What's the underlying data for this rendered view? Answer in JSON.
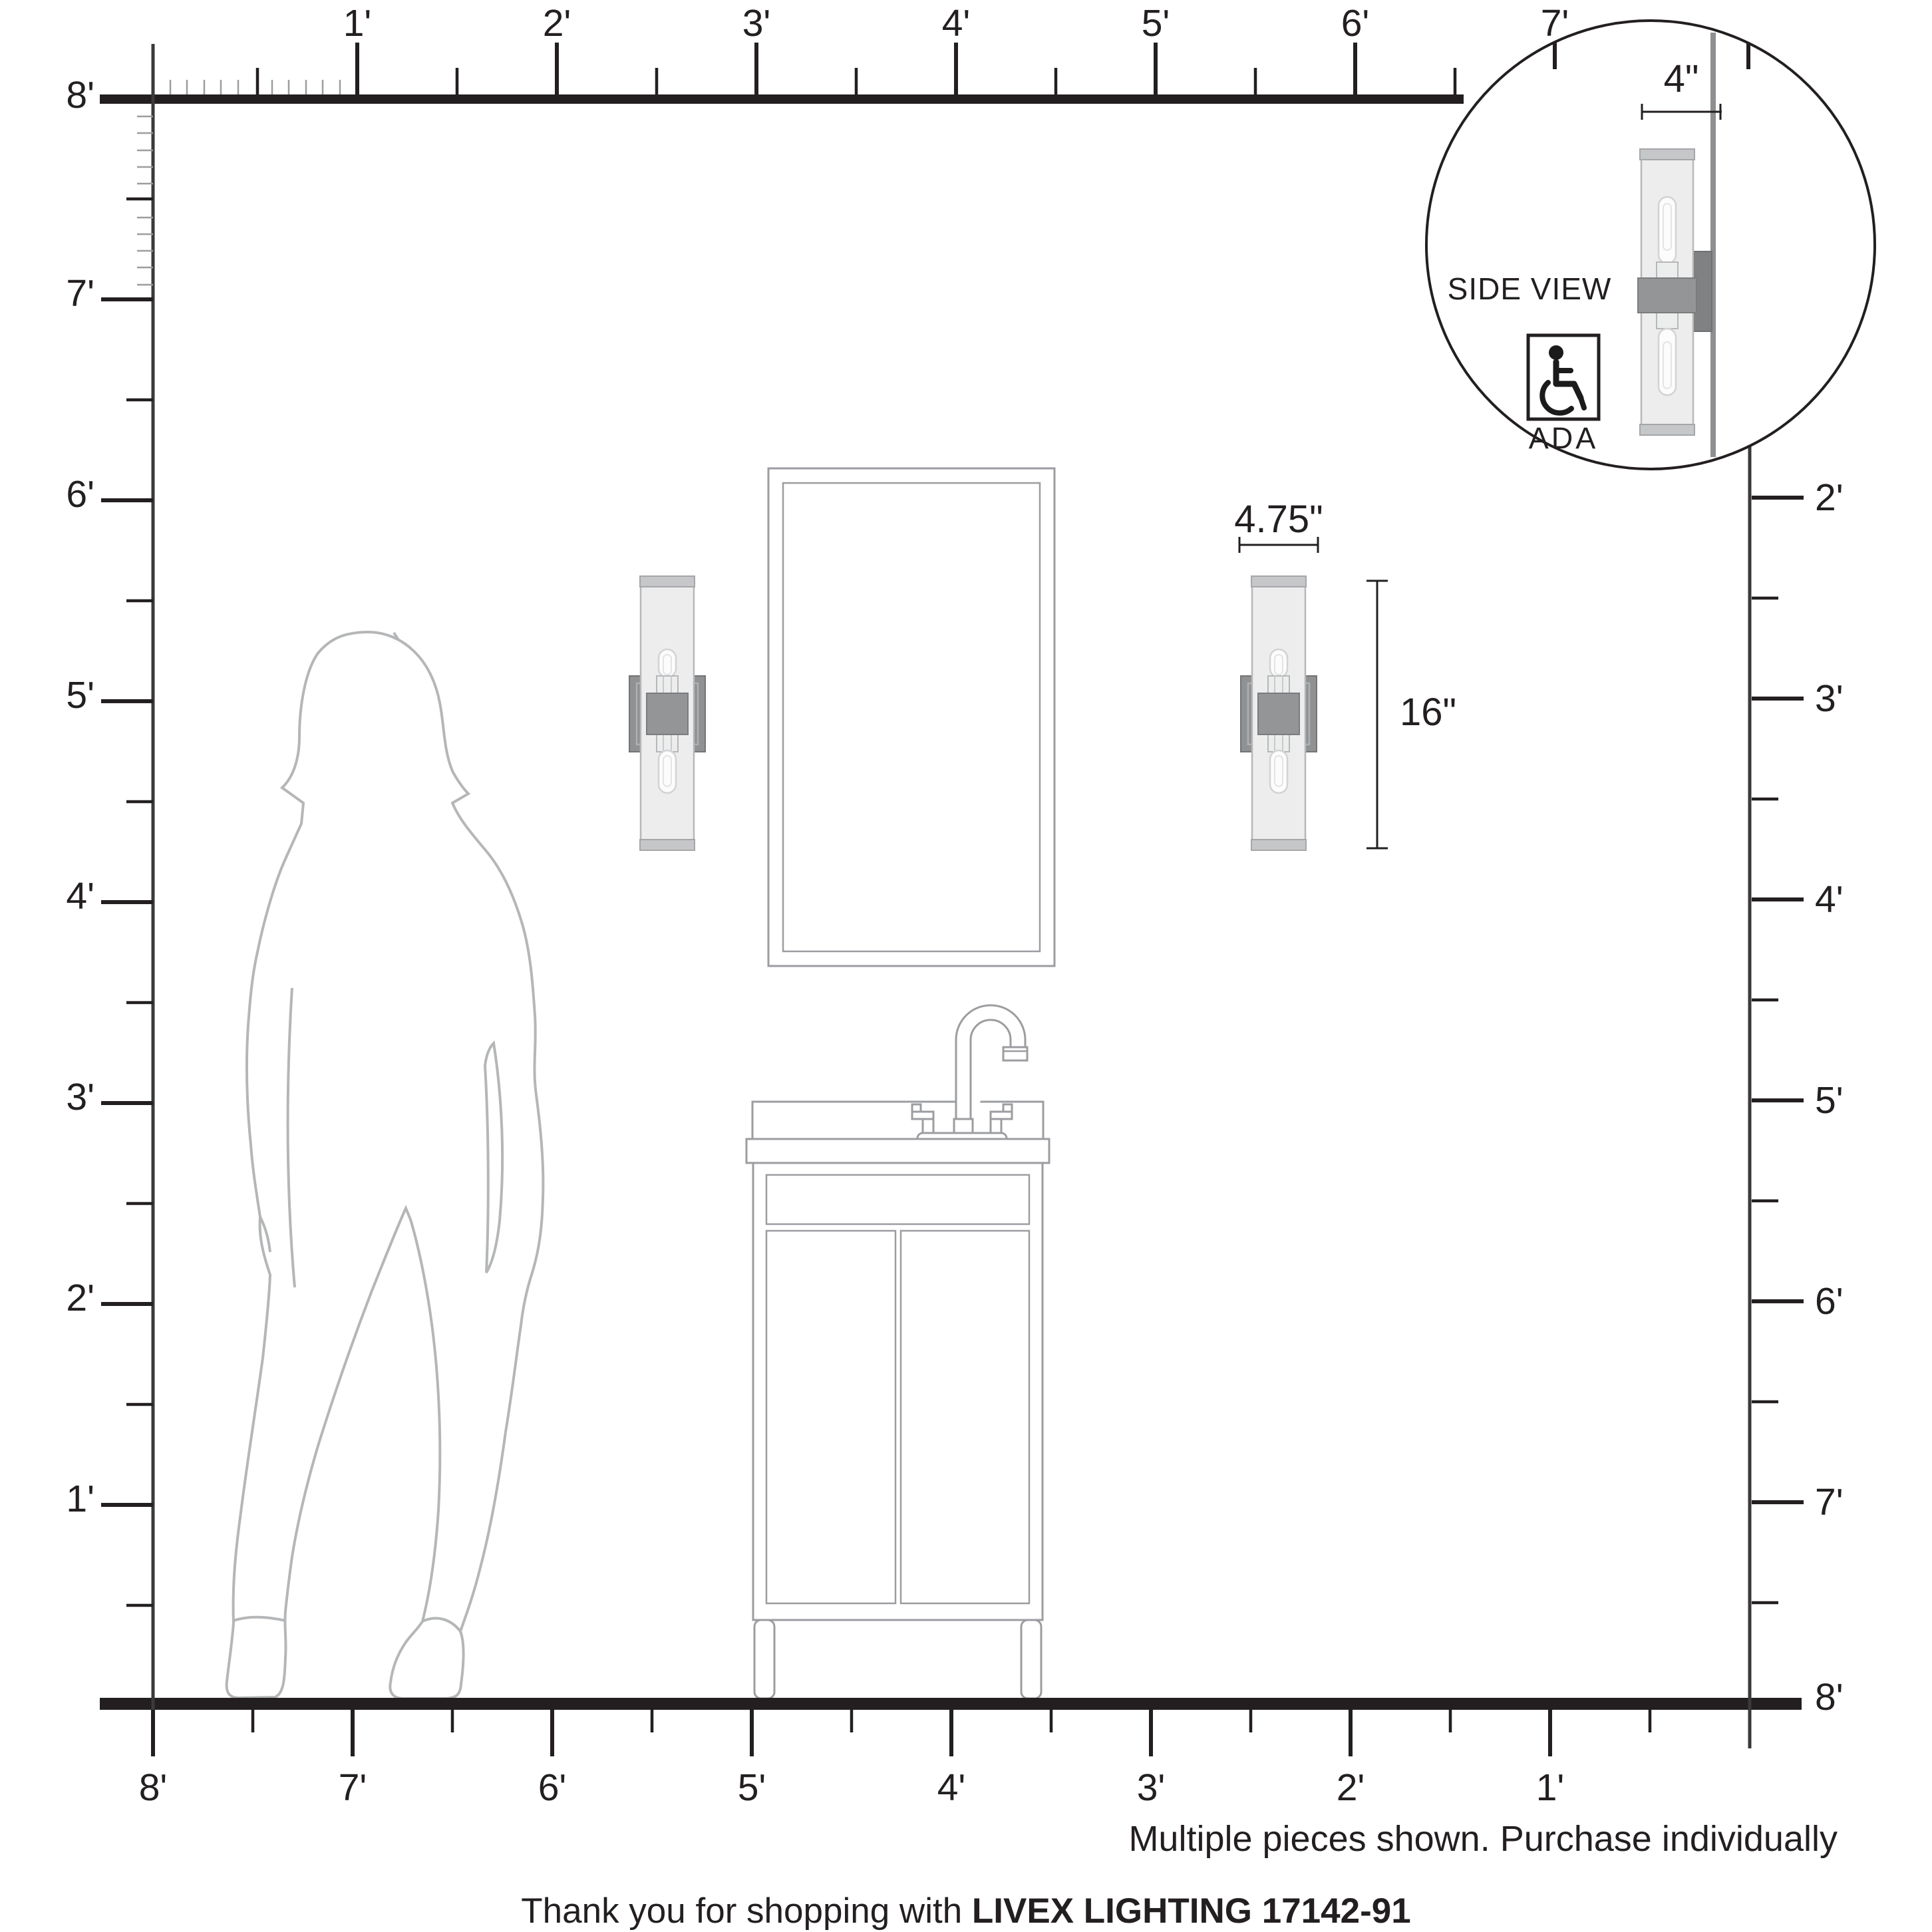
{
  "rulers": {
    "top": {
      "labels": [
        "1'",
        "2'",
        "3'",
        "4'",
        "5'",
        "6'",
        "7'"
      ]
    },
    "left": {
      "ceiling_label": "8'",
      "labels": [
        "7'",
        "6'",
        "5'",
        "4'",
        "3'",
        "2'",
        "1'"
      ]
    },
    "right": {
      "labels": [
        "2'",
        "3'",
        "4'",
        "5'",
        "6'",
        "7'",
        "8'"
      ]
    },
    "bottom": {
      "labels": [
        "8'",
        "7'",
        "6'",
        "5'",
        "4'",
        "3'",
        "2'",
        "1'"
      ]
    }
  },
  "inset": {
    "depth_label": "4\"",
    "side_view_label": "SIDE VIEW",
    "ada_label": "ADA"
  },
  "dimensions": {
    "width_label": "4.75\"",
    "height_label": "16\""
  },
  "footer": {
    "note": "Multiple pieces shown. Purchase individually",
    "thanks_prefix": "Thank you for shopping with ",
    "brand_model": "LIVEX LIGHTING 17142-91"
  },
  "icons": {
    "ada_symbol": "wheelchair-icon"
  },
  "colors": {
    "line_dark": "#231f20",
    "outline_gray": "#9b9da0",
    "silhouette_gray": "#b4b6b8",
    "metal_gray": "#8f9193",
    "band_gray": "#939597",
    "glass_gray": "#ededee",
    "wall_gray": "#8d8f91"
  }
}
